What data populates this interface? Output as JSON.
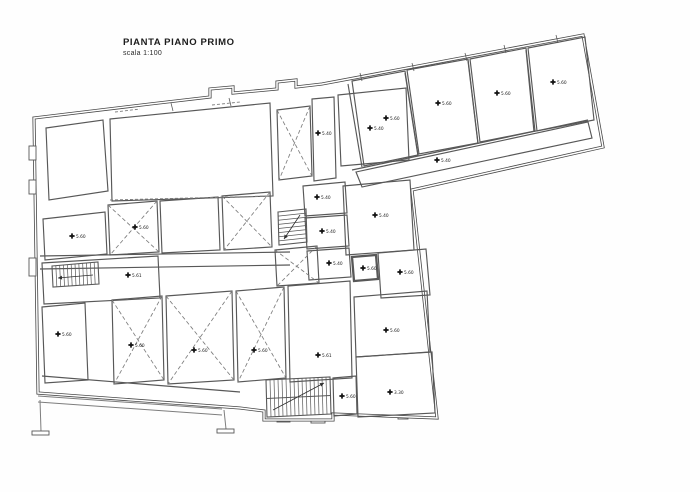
{
  "title": {
    "main": "PIANTA PIANO PRIMO",
    "scale": "scala 1:100"
  },
  "colors": {
    "ink": "#2f2f2f",
    "wall": "#474747",
    "thin": "#585858",
    "faint": "#7d7d7d",
    "bg": "#fefefe"
  },
  "plan": {
    "outer": "34,118 150,104 210,97 210,89 233,87 233,93 277,89 277,82 296,80 296,87 322,84 583,35 603,147 412,190 437,418 333,414 333,420 264,420 264,411 240,408 38,393",
    "bumps": [
      [
        29,
        146,
        7,
        14
      ],
      [
        29,
        180,
        7,
        14
      ],
      [
        29,
        258,
        7,
        18
      ]
    ],
    "walls": [
      {
        "pts": "352,170 588,120"
      },
      {
        "pts": "348,84 362,167"
      },
      {
        "pts": "405,73 418,156"
      },
      {
        "pts": "468,61 478,144"
      },
      {
        "pts": "526,50 534,132"
      },
      {
        "pts": "42,376 240,392"
      },
      {
        "pts": "40,256 290,252"
      },
      {
        "pts": "40,269 290,265"
      }
    ],
    "dashes": [
      {
        "pts": "115,112 140,109"
      },
      {
        "pts": "212,105 240,102"
      },
      {
        "pts": "110,200 270,196"
      }
    ],
    "ticks": [
      {
        "x": 361,
        "y": 77
      },
      {
        "x": 413,
        "y": 67
      },
      {
        "x": 466,
        "y": 57
      },
      {
        "x": 505,
        "y": 49
      },
      {
        "x": 557,
        "y": 39
      },
      {
        "x": 172,
        "y": 107
      },
      {
        "x": 230,
        "y": 102
      }
    ],
    "rooms": [
      {
        "name": "room-top-left",
        "pts": "46,128 103,120 108,191 49,200"
      },
      {
        "name": "hall-top-center",
        "pts": "110,119 270,103 273,196 112,201"
      },
      {
        "name": "room-x-narrow",
        "pts": "277,110 310,106 312,176 279,180",
        "cross": true
      },
      {
        "name": "corridor-vertical",
        "pts": "312,99 334,97 336,178 314,181",
        "label": {
          "x": 318,
          "y": 133,
          "v": "5.40"
        }
      },
      {
        "name": "room-r5",
        "pts": "338,95 406,88 409,160 341,166",
        "label": {
          "x": 370,
          "y": 128,
          "v": "5.40"
        }
      },
      {
        "name": "room-r18",
        "pts": "343,186 410,180 414,250 346,255",
        "label": {
          "x": 375,
          "y": 215,
          "v": "5.40"
        }
      },
      {
        "name": "room-r16",
        "pts": "378,253 426,249 430,295 381,298",
        "label": {
          "x": 400,
          "y": 272,
          "v": "5.60"
        }
      },
      {
        "name": "room-vault",
        "pts": "352,257 376,255 378,279 354,281",
        "thick": true,
        "label": {
          "x": 363,
          "y": 268,
          "v": "5.60"
        }
      },
      {
        "name": "room-ra",
        "pts": "303,186 345,182 347,213 305,216",
        "label": {
          "x": 317,
          "y": 197,
          "v": "5.40"
        }
      },
      {
        "name": "room-rb",
        "pts": "305,218 347,215 349,246 307,249",
        "label": {
          "x": 322,
          "y": 231,
          "v": "5.40"
        }
      },
      {
        "name": "room-rc",
        "pts": "307,251 349,248 351,277 309,280",
        "label": {
          "x": 329,
          "y": 263,
          "v": "5.40"
        }
      },
      {
        "name": "room-x1",
        "pts": "108,205 157,201 159,252 110,255",
        "cross": true,
        "label": {
          "x": 135,
          "y": 227,
          "v": "5.60"
        }
      },
      {
        "name": "room-mid",
        "pts": "160,201 218,197 220,250 162,253"
      },
      {
        "name": "room-x2",
        "pts": "222,196 270,192 272,247 224,250",
        "cross": true
      },
      {
        "name": "room-x7",
        "pts": "275,250 317,246 319,283 277,286",
        "cross": true
      },
      {
        "name": "room-r6",
        "pts": "43,219 105,212 107,254 45,260",
        "label": {
          "x": 72,
          "y": 236,
          "v": "5.60"
        }
      },
      {
        "name": "room-rl",
        "pts": "42,263 158,256 160,298 44,304",
        "label": {
          "x": 128,
          "y": 275,
          "v": "5.61"
        }
      },
      {
        "name": "room-r9",
        "pts": "42,307 85,303 88,380 45,383",
        "label": {
          "x": 58,
          "y": 334,
          "v": "5.60"
        }
      },
      {
        "name": "room-x4",
        "pts": "112,300 162,296 164,380 114,384",
        "cross": true,
        "label": {
          "x": 131,
          "y": 345,
          "v": "5.60"
        }
      },
      {
        "name": "room-x5",
        "pts": "166,296 232,291 234,380 168,384",
        "cross": true,
        "label": {
          "x": 194,
          "y": 350,
          "v": "5.60"
        }
      },
      {
        "name": "room-x6",
        "pts": "236,291 284,287 286,378 238,382",
        "cross": true,
        "label": {
          "x": 254,
          "y": 350,
          "v": "5.60"
        }
      },
      {
        "name": "room-r12",
        "pts": "288,286 350,281 352,378 290,382",
        "label": {
          "x": 318,
          "y": 355,
          "v": "5.61"
        }
      },
      {
        "name": "room-r11",
        "pts": "354,297 427,291 430,352 356,357",
        "label": {
          "x": 386,
          "y": 330,
          "v": "5.60"
        }
      },
      {
        "name": "room-r13",
        "pts": "356,357 432,352 435,413 358,417",
        "label": {
          "x": 390,
          "y": 392,
          "v": "3.30"
        }
      },
      {
        "name": "room-rs1",
        "pts": "333,378 356,376 357,414 334,416",
        "label": {
          "x": 342,
          "y": 396,
          "v": "5.60"
        }
      },
      {
        "name": "wing-room-1",
        "pts": "352,81 405,71 418,155 364,166",
        "label": {
          "x": 386,
          "y": 118,
          "v": "5.60"
        }
      },
      {
        "name": "wing-room-2",
        "pts": "407,70 468,59 478,143 419,154",
        "label": {
          "x": 438,
          "y": 103,
          "v": "5.60"
        }
      },
      {
        "name": "wing-room-3",
        "pts": "470,59 526,48 535,131 480,142",
        "label": {
          "x": 497,
          "y": 93,
          "v": "5.60"
        }
      },
      {
        "name": "wing-room-4",
        "pts": "528,48 585,37 594,120 537,131",
        "label": {
          "x": 553,
          "y": 82,
          "v": "5.60"
        }
      },
      {
        "name": "wing-corridor",
        "pts": "356,172 588,122 592,138 362,187",
        "label": {
          "x": 437,
          "y": 160,
          "v": "5.40"
        }
      }
    ],
    "stairs": [
      {
        "name": "stair-left",
        "pts": "52,266 98,262 99,284 53,287",
        "n": 12,
        "dir": "v",
        "arrow": [
          93,
          275,
          58,
          278
        ]
      },
      {
        "name": "stair-main",
        "pts": "266,380 330,377 331,414 267,417",
        "n": 16,
        "dir": "v",
        "divider": true,
        "arrow": [
          273,
          410,
          324,
          383
        ]
      },
      {
        "name": "stair-small",
        "pts": "278,212 306,209 307,242 279,245",
        "n": 8,
        "dir": "h",
        "arrow": [
          300,
          215,
          284,
          239
        ]
      }
    ],
    "terrace": {
      "lines": [
        "38,396 222,409",
        "38,402 222,415",
        "40,400 41,431",
        "224,410 226,429"
      ],
      "rects": [
        [
          32,
          431,
          17,
          4
        ],
        [
          217,
          429,
          17,
          4
        ],
        [
          77,
          386,
          21,
          11
        ],
        [
          186,
          385,
          22,
          10
        ],
        [
          131,
          385,
          6,
          12
        ],
        [
          142,
          385,
          6,
          12
        ],
        [
          277,
          413,
          13,
          9
        ],
        [
          311,
          414,
          14,
          9
        ],
        [
          398,
          412,
          10,
          7
        ]
      ]
    }
  }
}
